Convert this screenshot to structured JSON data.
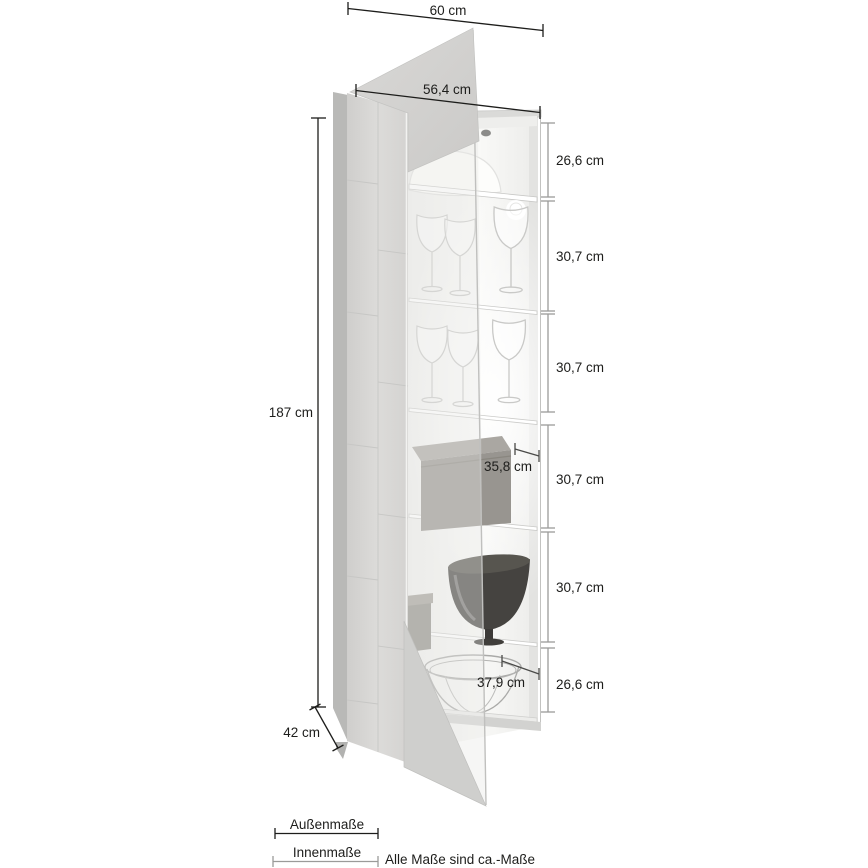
{
  "dims": {
    "width_outer": "60 cm",
    "width_front": "56,4 cm",
    "height_outer": "187 cm",
    "depth_outer": "42 cm",
    "sections": [
      "26,6 cm",
      "30,7 cm",
      "30,7 cm",
      "30,7 cm",
      "30,7 cm",
      "26,6 cm"
    ],
    "depth_inner": "35,8 cm",
    "width_inner": "37,9 cm"
  },
  "legend": {
    "outer": "Außenmaße",
    "inner": "Innenmaße",
    "note": "Alle Maße sind ca.-Maße"
  },
  "colors": {
    "dim_outer_line": "#1d1d1b",
    "dim_inner_line": "#9b9b99",
    "text": "#1d1d1b",
    "cabinet_light": "#d7d6d4",
    "cabinet_dark": "#b9b9b7",
    "interior": "#f6f6f4"
  }
}
